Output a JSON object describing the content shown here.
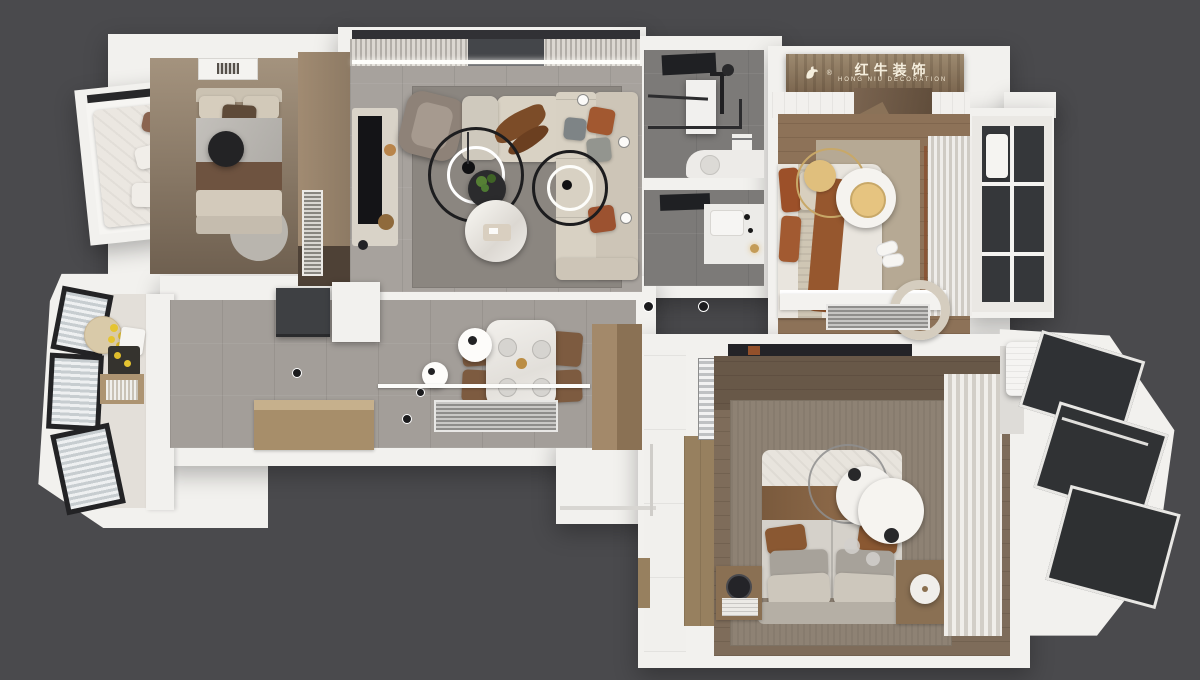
{
  "sign": {
    "title_cn": "红牛装饰",
    "subtitle_en": "HONG NIU DECORATION",
    "registered": "®",
    "logo_icon": "bull-logo-icon"
  },
  "palette": {
    "background": "#4a4a4d",
    "wall_white": "#f2f1ee",
    "tile_grey": "#a7a29d",
    "rug_grey": "#8b8680",
    "wood_warm": "#8d7258",
    "wood_dark": "#7e6c5a",
    "wood_cabinet": "#97805f",
    "sofa_beige": "#d8d1c3",
    "accent_rust": "#9c5029",
    "accent_gold": "#e0bf7d",
    "glass_dark": "#35373a",
    "fixture_black": "#232326"
  },
  "scene": {
    "type": "3d-floor-plan-render",
    "view": "top-down apartment render on dark grey backdrop",
    "rooms": [
      {
        "name": "second-bedroom",
        "items": [
          "bed",
          "black-stool",
          "round-rug",
          "wardrobe",
          "runner-rug",
          "bay-window-daybed",
          "ceiling-vent"
        ]
      },
      {
        "name": "living-room",
        "items": [
          "curtain-wall",
          "tv-console",
          "tv",
          "armchair",
          "l-sofa",
          "ottoman",
          "driftwood-decor",
          "ring-pendant-light",
          "ring-pendant-light-2",
          "plant-side-table",
          "round-coffee-table",
          "area-rug"
        ]
      },
      {
        "name": "bathroom",
        "items": [
          "shower-room",
          "glass-partition",
          "towel-rack",
          "vanity",
          "wash-basin",
          "mirror-cabinet"
        ]
      },
      {
        "name": "master-bedroom-top",
        "items": [
          "brand-sign",
          "plank-ceiling",
          "wood-canopy",
          "bed",
          "rust-throw",
          "gold-disc-pendant",
          "white-disc-pendant",
          "slippers",
          "curtains",
          "balcony-windows",
          "desk",
          "chair",
          "striped-mat"
        ]
      },
      {
        "name": "kitchen",
        "items": [
          "angled-windows",
          "round-table",
          "lemons",
          "cooktop",
          "wood-cabinet",
          "counter"
        ]
      },
      {
        "name": "entry-hall",
        "items": [
          "tv-panel",
          "white-cabinet",
          "shoe-bench",
          "ceiling-spots"
        ]
      },
      {
        "name": "dining-room",
        "items": [
          "marble-dining-table",
          "four-chairs",
          "pendant-lamps",
          "striped-bench",
          "ledge",
          "wood-column-cabinet"
        ]
      },
      {
        "name": "master-bedroom",
        "items": [
          "bed",
          "headboard",
          "disc-pendant-lamps",
          "nightstands",
          "table-lamp",
          "drum-lamp",
          "wardrobe",
          "mirror",
          "rug",
          "curtains",
          "balcony-glazing",
          "ac-unit"
        ]
      }
    ]
  }
}
